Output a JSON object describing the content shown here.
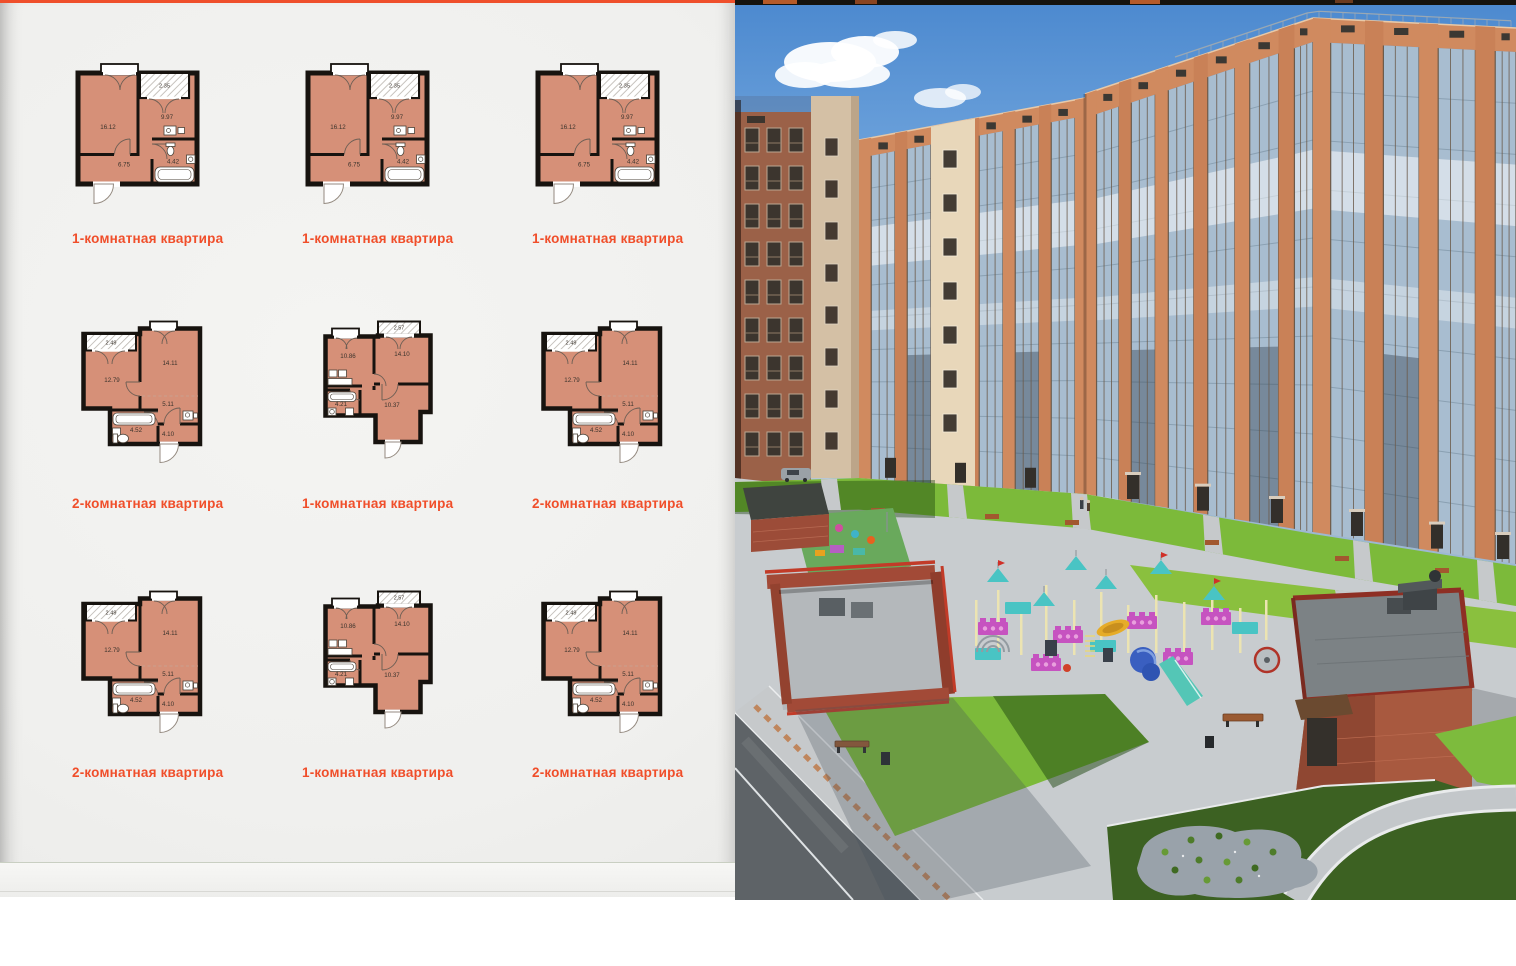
{
  "page": {
    "accent_color": "#ef4f2b",
    "label_color": "#f04e2a",
    "plan_room_fill": "#d69078",
    "plan_wall_color": "#17130f",
    "plan_number_color": "#3a332c",
    "plans": [
      {
        "type": "A",
        "label": "1-комнатная квартира",
        "areas": {
          "living": "16.12",
          "kitchen": "9.97",
          "hallway": "6.75",
          "bathroom": "4.42",
          "balcony": "2.35"
        }
      },
      {
        "type": "A",
        "label": "1-комнатная квартира",
        "areas": {
          "living": "16.12",
          "kitchen": "9.97",
          "hallway": "6.75",
          "bathroom": "4.42",
          "balcony": "2.35"
        }
      },
      {
        "type": "A",
        "label": "1-комнатная квартира",
        "areas": {
          "living": "16.12",
          "kitchen": "9.97",
          "hallway": "6.75",
          "bathroom": "4.42",
          "balcony": "2.35"
        }
      },
      {
        "type": "B",
        "label": "2-комнатная квартира",
        "areas": {
          "balcony": "2.49",
          "bedroom": "12.79",
          "living": "14.11",
          "hallway": "5.11",
          "bathroom": "4.52",
          "entry": "4.10"
        }
      },
      {
        "type": "C",
        "label": "1-комнатная квартира",
        "areas": {
          "balcony": "2.57",
          "kitchen": "10.86",
          "living": "14.10",
          "bathroom": "4.21",
          "hallway": "10.37"
        }
      },
      {
        "type": "B",
        "label": "2-комнатная квартира",
        "areas": {
          "balcony": "2.49",
          "bedroom": "12.79",
          "living": "14.11",
          "hallway": "5.11",
          "bathroom": "4.52",
          "entry": "4.10"
        }
      },
      {
        "type": "B",
        "label": "2-комнатная квартира",
        "areas": {
          "balcony": "2.49",
          "bedroom": "12.79",
          "living": "14.11",
          "hallway": "5.11",
          "bathroom": "4.52",
          "entry": "4.10"
        }
      },
      {
        "type": "C",
        "label": "1-комнатная квартира",
        "areas": {
          "balcony": "2.57",
          "kitchen": "10.86",
          "living": "14.10",
          "bathroom": "4.21",
          "hallway": "10.37"
        }
      },
      {
        "type": "B",
        "label": "2-комнатная квартира",
        "areas": {
          "balcony": "2.49",
          "bedroom": "12.79",
          "living": "14.11",
          "hallway": "5.11",
          "bathroom": "4.52",
          "entry": "4.10"
        }
      }
    ]
  },
  "photo": {
    "colors": {
      "sky_top": "#4c89cf",
      "sky_mid": "#7fb0e2",
      "sky_low": "#cfe2f3",
      "cloud": "#ffffff",
      "brick_lit": "#d08a5f",
      "brick_mid": "#c98157",
      "brick_dark": "#a76a50",
      "cream": "#e8d7ba",
      "glass": "#a8bdd0",
      "glass_line": "#8aa0b2",
      "frame": "#6b5a4a",
      "attic": "#3b3833",
      "lawn_lit": "#7cba3a",
      "lawn_bright": "#8ac03e",
      "lawn_dark": "#3c6122",
      "plaza": "#c8cccf",
      "path": "#c6c9cb",
      "road": "#5e6367",
      "curb": "#eef0f1",
      "paver": "#bd7a4a",
      "enclosure_brick": "#a24a37",
      "enclosure_cap": "#c23b28",
      "roof_gray": "#7c8285",
      "play_teal": "#49c4c4",
      "play_purple": "#c653c0",
      "play_cream": "#ece4b2",
      "play_blue": "#3a5fc0",
      "play_yellow": "#e6ac28",
      "slide_teal": "#54c6b6",
      "bench": "#9a5a32",
      "bush": "#4e7c2a",
      "gravel": "#99a2aa"
    }
  }
}
